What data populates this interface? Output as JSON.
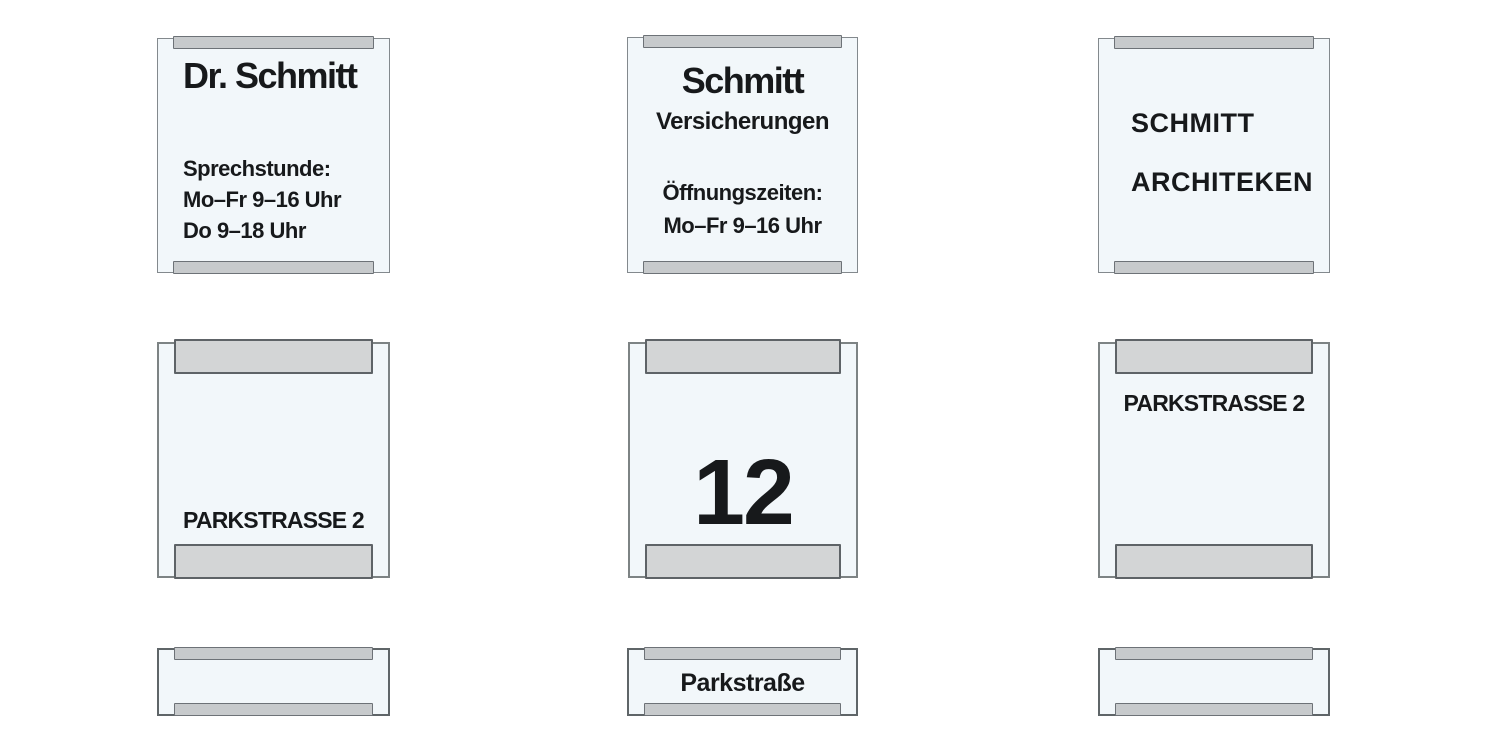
{
  "canvas": {
    "background": "#ffffff",
    "width": 1490,
    "height": 746
  },
  "colors": {
    "panel_fill": "#f2f7fa",
    "panel_border": "#7d8384",
    "rail_fill_thin": "#c7cacc",
    "rail_fill_thick": "#d3d5d6",
    "rail_border": "#5e6367",
    "text": "#17191b"
  },
  "signs": {
    "doctor": {
      "title": "Dr. Schmitt",
      "lines": [
        "Sprechstunde:",
        "Mo–Fr 9–16 Uhr",
        "Do 9–18 Uhr"
      ]
    },
    "insurance": {
      "title": "Schmitt",
      "subtitle": "Versicherungen",
      "lines": [
        "Öffnungszeiten:",
        "Mo–Fr 9–16 Uhr"
      ]
    },
    "architects": {
      "lines": [
        "SCHMITT",
        "ARCHITEKEN"
      ]
    },
    "street_plate_bottom": {
      "label": "PARKSTRASSE 2"
    },
    "house_number_plate": {
      "number": "12"
    },
    "street_plate_top": {
      "label": "PARKSTRASSE 2"
    },
    "street_strip": {
      "label": "Parkstraße"
    }
  }
}
